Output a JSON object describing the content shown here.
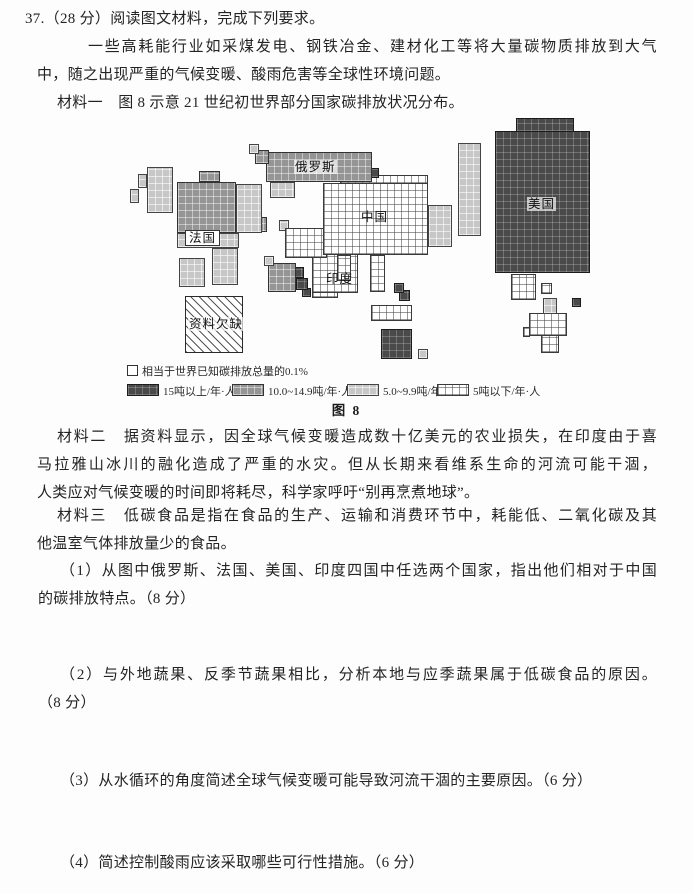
{
  "content": {
    "header": "37.（28 分）阅读图文材料，完成下列要求。",
    "intro": [
      "一些高耗能行业如采煤发电、钢铁冶金、建材化工等将大量碳物质排放到大气",
      "中，随之出现严重的气候变暖、酸雨危害等全球性环境问题。"
    ],
    "material1": "材料一　图 8 示意 21 世纪初世界部分国家碳排放状况分布。",
    "material2": [
      "材料二　据资料显示，因全球气候变暖造成数十亿美元的农业损失，在印度由于喜",
      "马拉雅山冰川的融化造成了严重的水灾。但从长期来看维系生命的河流可能干涸，",
      "人类应对气候变暖的时间即将耗尽，科学家呼吁“别再烹煮地球”。"
    ],
    "material3": [
      "材料三　低碳食品是指在食品的生产、运输和消费环节中，耗能低、二氧化碳及其",
      "他温室气体排放量少的食品。"
    ],
    "q1": [
      "（1）从图中俄罗斯、法国、美国、印度四国中任选两个国家，指出他们相对于中国",
      "的碳排放特点。（8 分）"
    ],
    "q2": [
      "（2）与外地蔬果、反季节蔬果相比，分析本地与应季蔬果属于低碳食品的原因。",
      "（8 分）"
    ],
    "q3": "（3）从水循环的角度简述全球气候变暖可能导致河流干涸的主要原因。（6 分）",
    "q4": "（4）简述控制酸雨应该采取哪些可行性措施。（6 分）"
  },
  "figure": {
    "caption": "图 8",
    "unit_note": "相当于世界已知碳排放总量的0.1%",
    "legend": [
      {
        "label": "15吨以上/年·人",
        "category": "cat1",
        "color": "#4a4a4a"
      },
      {
        "label": "10.0~14.9吨/年·人",
        "category": "cat2",
        "color": "#959595"
      },
      {
        "label": "5.0~9.9吨/年·人",
        "category": "cat3",
        "color": "#c7c7c7"
      },
      {
        "label": "5吨以下/年·人",
        "category": "cat4",
        "color": "#ffffff"
      }
    ],
    "labels": {
      "russia": "俄罗斯",
      "china": "中国",
      "france": "法国",
      "india": "印度",
      "usa": "美国",
      "no_data": "资料欠缺"
    }
  }
}
